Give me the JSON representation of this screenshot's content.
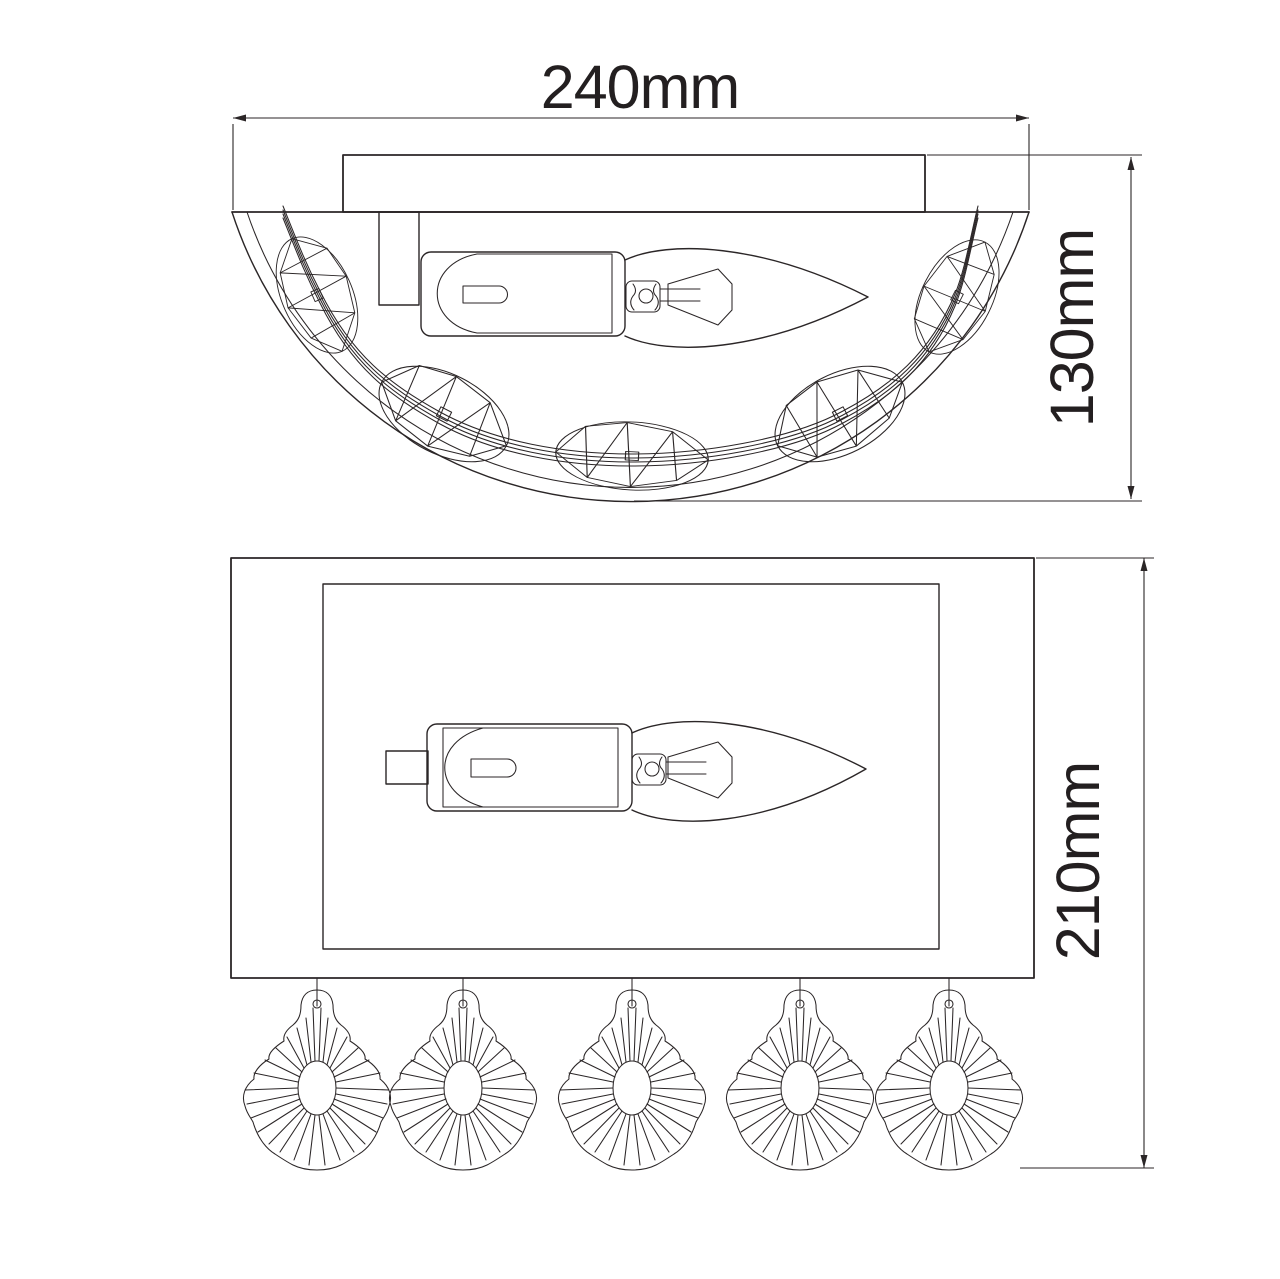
{
  "canvas": {
    "width": 1280,
    "height": 1279,
    "background": "#ffffff",
    "line_color": "#2b2627"
  },
  "dimensions": {
    "width": "240mm",
    "depth": "130mm",
    "height": "210mm"
  },
  "views": {
    "top": {
      "crystal_count": 5
    },
    "front": {
      "pendant_count": 5
    }
  }
}
